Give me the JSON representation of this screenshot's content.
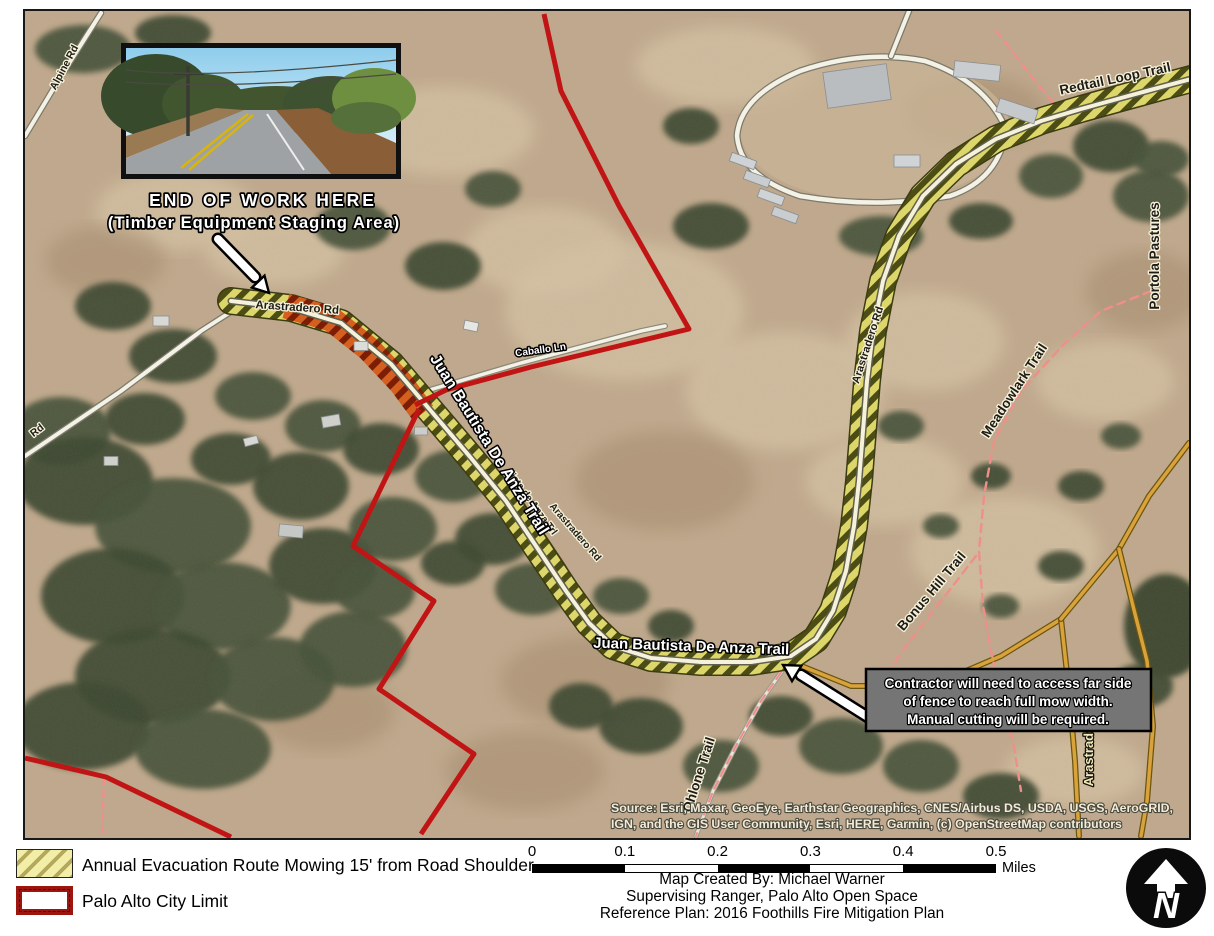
{
  "map": {
    "inset_caption_line1": "END OF WORK HERE",
    "inset_caption_line2": "(Timber Equipment Staging Area)",
    "callout": {
      "line1": "Contractor will need to access far side",
      "line2": "of fence to reach full mow width.",
      "line3": "Manual cutting will be required."
    },
    "road_labels": {
      "alpine_rd": "Alpine Rd",
      "rd_partial": "Rd",
      "arastradero_rd_west": "Arastradero Rd",
      "caballo_ln": "Caballo Ln",
      "juan_bautista_upper": "Juan Bautista De Anza Trail",
      "anza_trl_small": "ista de Anza Trl",
      "arastradero_rd_mid": "Arastradero Rd",
      "arastradero_rd_east": "Arastradero Rd",
      "juan_bautista_lower": "Juan Bautista De Anza Trail",
      "redtail_loop_trail": "Redtail Loop Trail",
      "portola_pastures": "Portola Pastures",
      "meadowlark_trail": "Meadowlark Trail",
      "bonus_hill_trail": "Bonus Hill Trail",
      "ohlone_trail": "Ohlone Trail",
      "arastradero_creek_partial": "Arastradero C"
    },
    "attribution_line1": "Source: Esri, Maxar, GeoEye, Earthstar Geographics, CNES/Airbus DS, USDA, USGS, AeroGRID,",
    "attribution_line2": "IGN, and the GIS User Community, Esri, HERE, Garmin, (c) OpenStreetMap contributors"
  },
  "legend": {
    "items": [
      {
        "id": "mow-route",
        "label": "Annual Evacuation Route Mowing 15' from Road Shoulder"
      },
      {
        "id": "city-limit",
        "label": "Palo Alto City Limit"
      }
    ]
  },
  "scale_bar": {
    "ticks": [
      "0",
      "0.1",
      "0.2",
      "0.3",
      "0.4",
      "0.5"
    ],
    "unit": "Miles"
  },
  "credits": {
    "line1": "Map Created By: Michael Warner",
    "line2": "Supervising Ranger, Palo Alto Open Space",
    "line3": "Reference Plan: 2016 Foothills Fire Mitigation Plan"
  },
  "north_arrow_letter": "N",
  "colors": {
    "route_hatch_fill": "#ddd76b",
    "route_hatch_stripe": "#4c4c15",
    "route_overlap_orange": "#d45f1e",
    "city_limit_red": "#c11414",
    "legend_swatch_fill": "#f2eea8",
    "legend_swatch_stripe": "#b3a85c",
    "minor_road_yellow": "#d9a23a",
    "trail_pink": "#ef8f8a",
    "satellite_base": "#c0a98d",
    "callout_gray": "#757575"
  }
}
